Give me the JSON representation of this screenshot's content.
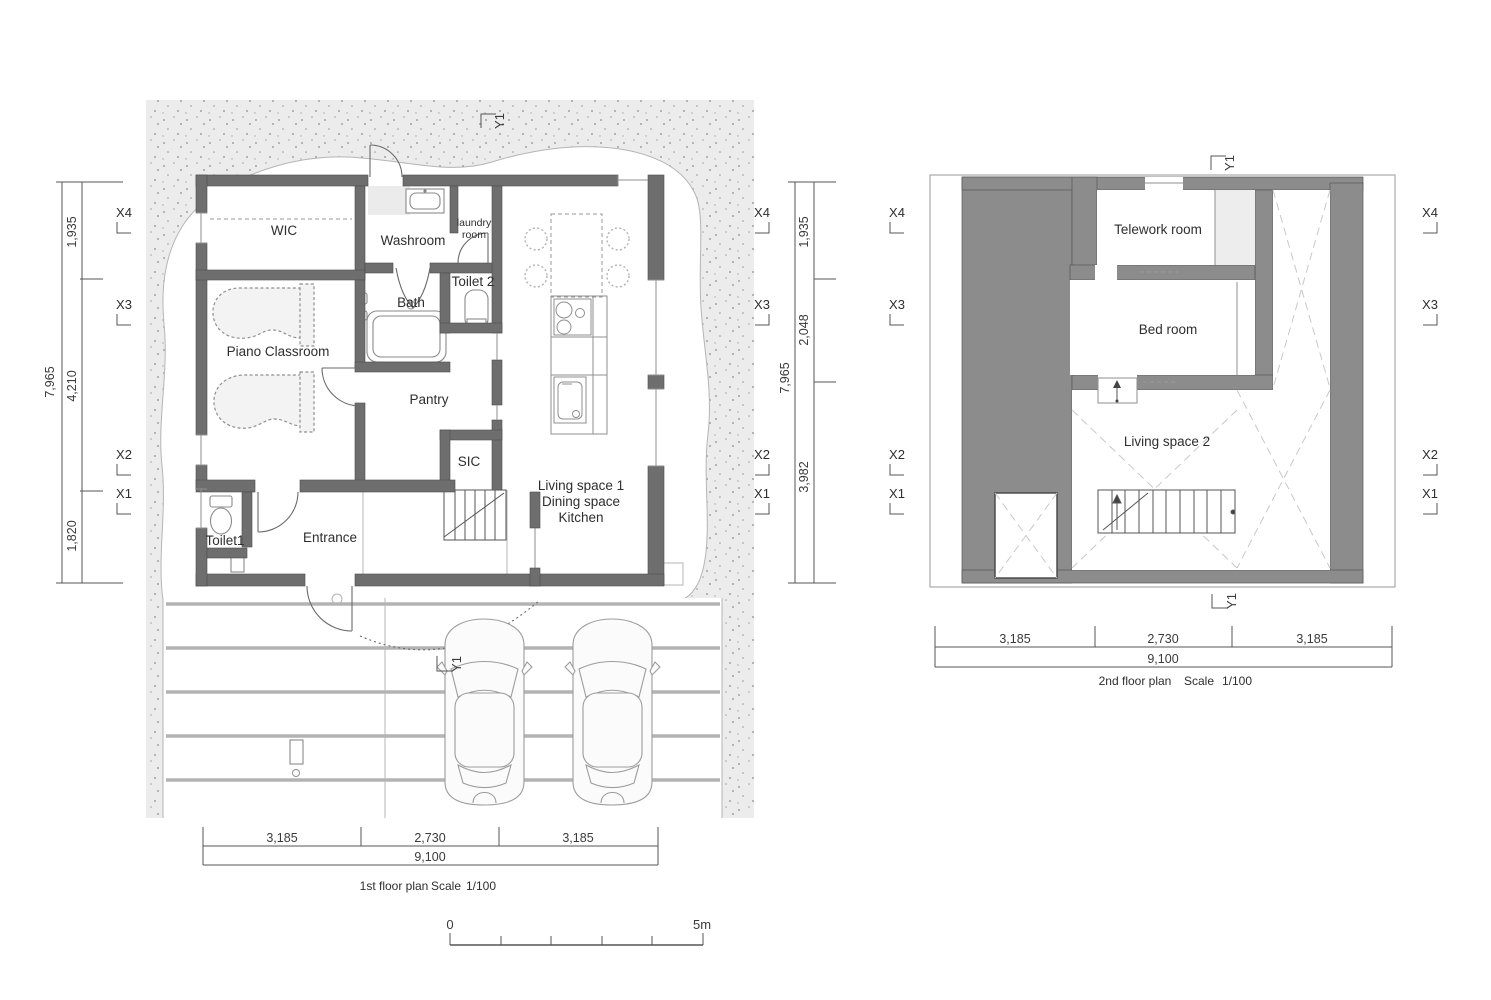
{
  "colors": {
    "wall_fill": "#6e6e6e",
    "deck_fill": "#8c8c8c",
    "site_fill": "#ececec",
    "stripe": "#b3b3b3",
    "drawing_line": "#555555",
    "text": "#2e2e2e"
  },
  "floor1": {
    "rooms": {
      "wic": "WIC",
      "washroom": "Washroom",
      "laundry_line1": "laundry",
      "laundry_line2": "room",
      "toilet2": "Toilet 2",
      "bath": "Bath",
      "piano": "Piano Classroom",
      "pantry": "Pantry",
      "sic": "SIC",
      "toilet1": "Toilet1",
      "entrance": "Entrance",
      "living_line1": "Living space 1",
      "living_line2": "Dining space",
      "living_line3": "Kitchen"
    },
    "grid": {
      "x": [
        "X4",
        "X3",
        "X2",
        "X1"
      ],
      "y_top": "Y1",
      "y_bottom": "Y1"
    },
    "dims": {
      "left_total": "7,965",
      "left_segments": [
        "1,935",
        "4,210",
        "1,820"
      ],
      "right_total": "7,965",
      "right_segments": [
        "1,935",
        "2,048",
        "3,982"
      ],
      "bottom_segments": [
        "3,185",
        "2,730",
        "3,185"
      ],
      "bottom_total": "9,100"
    },
    "caption": {
      "title": "1st floor plan",
      "scale_label": "Scale",
      "scale_value": "1/100"
    }
  },
  "floor2": {
    "rooms": {
      "telework": "Telework room",
      "bedroom": "Bed room",
      "living2": "Living space 2"
    },
    "grid": {
      "x": [
        "X4",
        "X3",
        "X2",
        "X1"
      ],
      "y_top": "Y1",
      "y_bottom": "Y1"
    },
    "dims": {
      "bottom_segments": [
        "3,185",
        "2,730",
        "3,185"
      ],
      "bottom_total": "9,100"
    },
    "caption": {
      "title": "2nd floor plan",
      "scale_label": "Scale",
      "scale_value": "1/100"
    }
  },
  "scale_bar": {
    "zero": "0",
    "five": "5m"
  }
}
